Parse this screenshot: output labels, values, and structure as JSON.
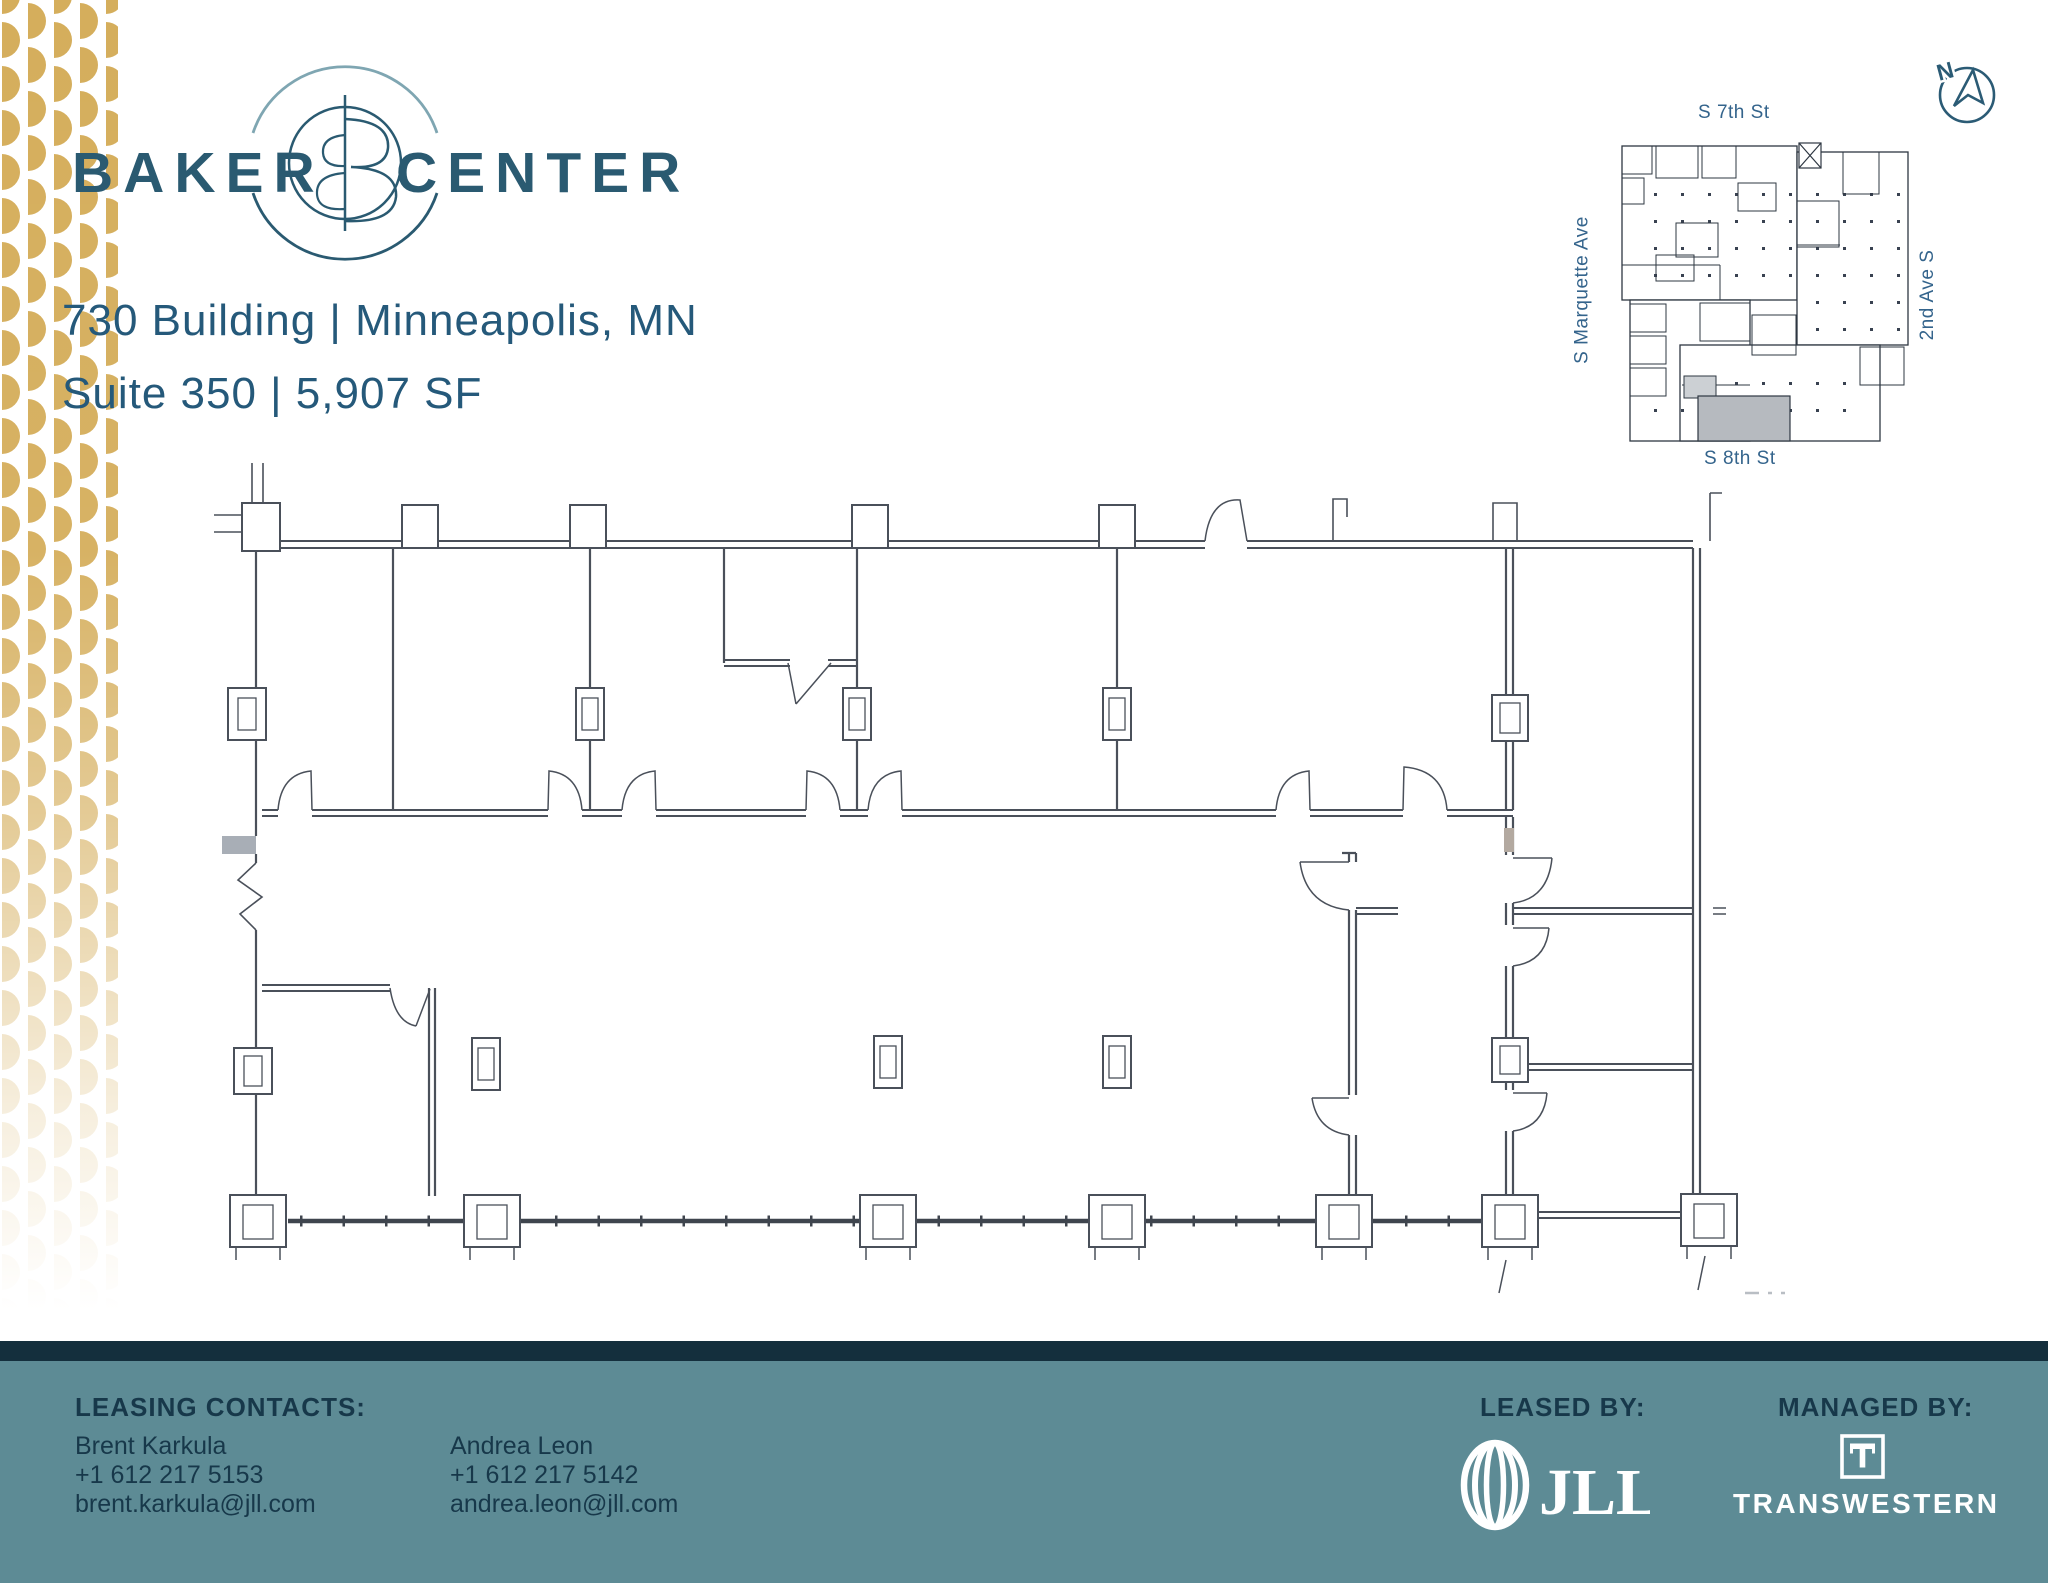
{
  "brand": {
    "word_left": "BAKER",
    "word_right": "CENTER"
  },
  "listing": {
    "line1": "730 Building | Minneapolis, MN",
    "line2": "Suite 350 | 5,907 SF"
  },
  "key_map": {
    "street_top": "S 7th St",
    "street_left": "S Marquette Ave",
    "street_right": "2nd Ave S",
    "street_bottom": "S 8th St",
    "compass_letter": "N"
  },
  "footer": {
    "leasing_heading": "LEASING CONTACTS:",
    "contacts": [
      {
        "name": "Brent Karkula",
        "phone": "+1 612 217 5153",
        "email": "brent.karkula@jll.com"
      },
      {
        "name": "Andrea Leon",
        "phone": "+1 612 217 5142",
        "email": "andrea.leon@jll.com"
      }
    ],
    "leased_by_label": "LEASED BY:",
    "managed_by_label": "MANAGED BY:",
    "jll_wordmark": "JLL",
    "transwestern_wordmark": "TRANSWESTERN"
  },
  "colors": {
    "brand_teal": "#2a5a71",
    "arc_light": "#7fa6b2",
    "gold_pattern": "#d5ae5c",
    "footer_navy": "#142f3d",
    "footer_teal": "#5d8b95",
    "footer_text": "#17384a",
    "map_label_blue": "#34648c",
    "plan_line": "#4a505a",
    "suite_highlight_gray": "#b6babf"
  }
}
